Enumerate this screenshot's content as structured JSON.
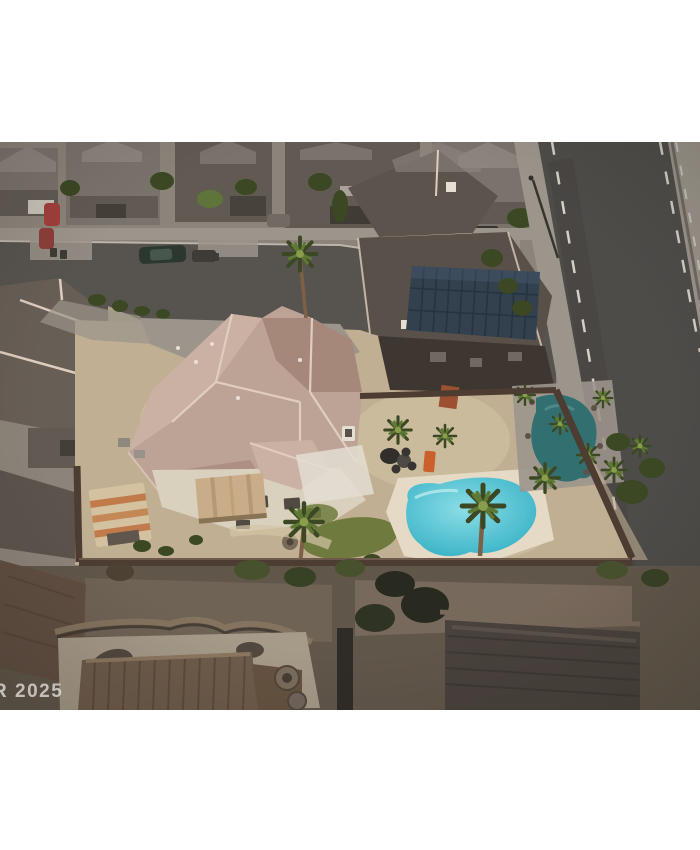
{
  "page": {
    "background_color": "#ffffff"
  },
  "photo": {
    "kind": "aerial-real-estate-photograph",
    "alt": "Aerial drone view of a suburban desert home with a tan tile roof, striped canopy shed, backyard swimming pool with palm trees, perimeter block wall, a neighboring house with rooftop solar panels, a multi-lane road on the right and a residential street with parked cars at the top.",
    "watermark": {
      "text": "R 2025"
    },
    "scene": {
      "features": [
        "neighborhood-houses",
        "residential-street",
        "parked-cars",
        "main-road",
        "bike-lane-markings",
        "main-house-tile-roof",
        "tan-awning",
        "striped-canopy-shed",
        "backyard-swimming-pool",
        "pool-deck",
        "lawn-patch",
        "palm-trees",
        "patio-furniture",
        "orange-lounger",
        "perimeter-wall",
        "solar-panel-roof",
        "neighbor-pool",
        "shaded-neighbor-yards",
        "tiled-roof-below",
        "curved-garden-wall"
      ],
      "colors": {
        "page-bg": "#ffffff",
        "ground": "#8d857b",
        "street": "#55524d",
        "road": "#4b4a47",
        "road-dash": "#d8d5cc",
        "sidewalk": "#9d978d",
        "house-gray": "#7a736c",
        "house-gray-dark": "#5f5952",
        "house-gray-light": "#8d867e",
        "roof-pink": "#c0a598",
        "roof-pink-light": "#cfb5a7",
        "roof-pink-dark": "#a8897c",
        "ridge": "#e4d2c2",
        "wall-cream": "#ded5c2",
        "awning": "#ccb08a",
        "shed": "#d8c6a2",
        "shed-stripe": "#c57c48",
        "sand": "#c4b395",
        "sand-light": "#d8c9a9",
        "lawn": "#6e7c3b",
        "pool": "#2fb3c9",
        "pool-light": "#8ce4ec",
        "pool-deck": "#e9e0ca",
        "neighbor-pool": "#2e6f70",
        "palm": "#5c7a31",
        "palm-dark": "#37461f",
        "palm-light": "#8aa04b",
        "trunk": "#7d5f43",
        "wall-brown": "#4a392e",
        "solar-roof": "#5a524a",
        "solar-panel": "#2f3e4c",
        "solar-line": "#22303b",
        "shadow": "#3a342e",
        "gravel": "#6e6254",
        "patio": "#a89d8a",
        "tile-roof": "#6d5b49",
        "dark-roof": "#453f39",
        "curved-wall": "#84735d",
        "lounger": "#cf5f2a",
        "watermark": "#e8e6e2"
      }
    }
  }
}
